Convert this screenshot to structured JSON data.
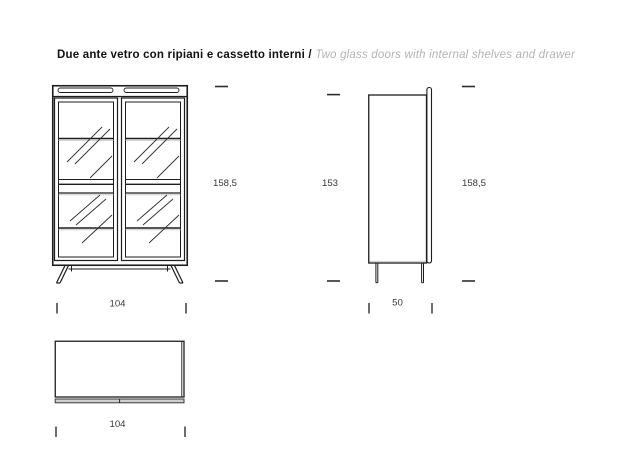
{
  "title": {
    "italian": "Due ante vetro con ripiani e cassetto interni / ",
    "english": "Two glass doors with internal shelves and drawer"
  },
  "dimensions": {
    "front_height": "158,5",
    "carcass_height": "153",
    "side_total_height": "158,5",
    "front_width": "104",
    "side_depth": "50",
    "plan_width": "104"
  },
  "colors": {
    "background": "#ffffff",
    "line": "#1d1d1d",
    "shadow_gray": "#c4c4c4",
    "band_fill": "#cfcfcf",
    "dimension_text": "#383838",
    "title_text": "#111111",
    "title_english": "#b3b3b3"
  }
}
